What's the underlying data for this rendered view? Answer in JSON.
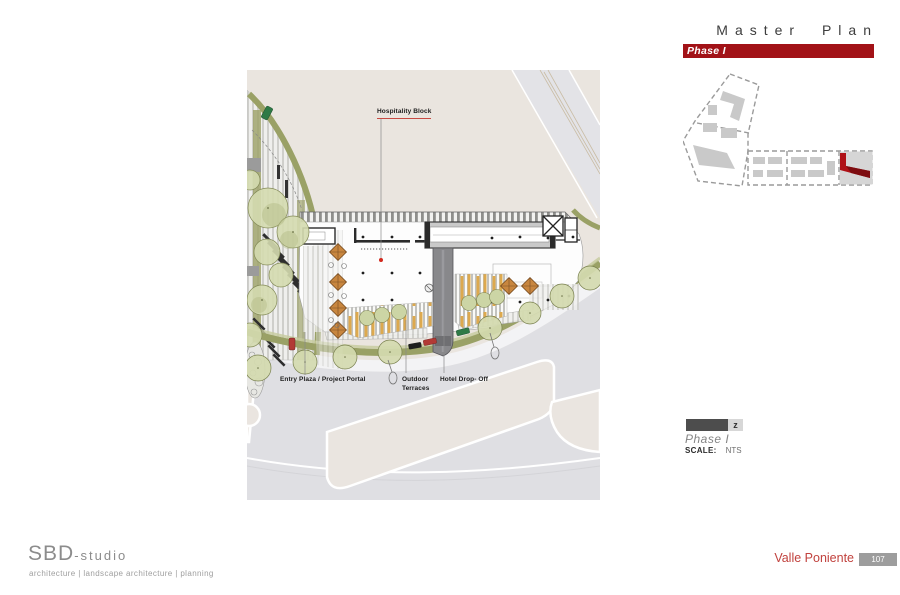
{
  "header": {
    "title": "Master Plan",
    "phase_banner": "Phase I"
  },
  "plan_labels": {
    "hospitality": "Hospitality Block",
    "entry": "Entry Plaza / Project Portal",
    "outdoor_line1": "Outdoor",
    "outdoor_line2": "Terraces",
    "dropoff": "Hotel Drop- Off"
  },
  "legend": {
    "north_glyph": "z",
    "phase": "Phase I",
    "scale_label": "SCALE:",
    "scale_value": "NTS"
  },
  "footer": {
    "studio": "SBD",
    "studio_suffix": "-studio",
    "tagline": "architecture | landscape architecture |  planning",
    "project": "Valle Poniente",
    "page": "107"
  },
  "colors": {
    "banner_red": "#A21217",
    "highlight_red": "#AF1117",
    "accent_red": "#C1423E",
    "plan_beige": "#EAE5DF",
    "road_gray": "#DFDFE3",
    "olive_green": "#9AA166",
    "tree_green": "#D4DAAF",
    "umbrella_orange": "#C8863F",
    "page_box_gray": "#9D9D9D"
  }
}
